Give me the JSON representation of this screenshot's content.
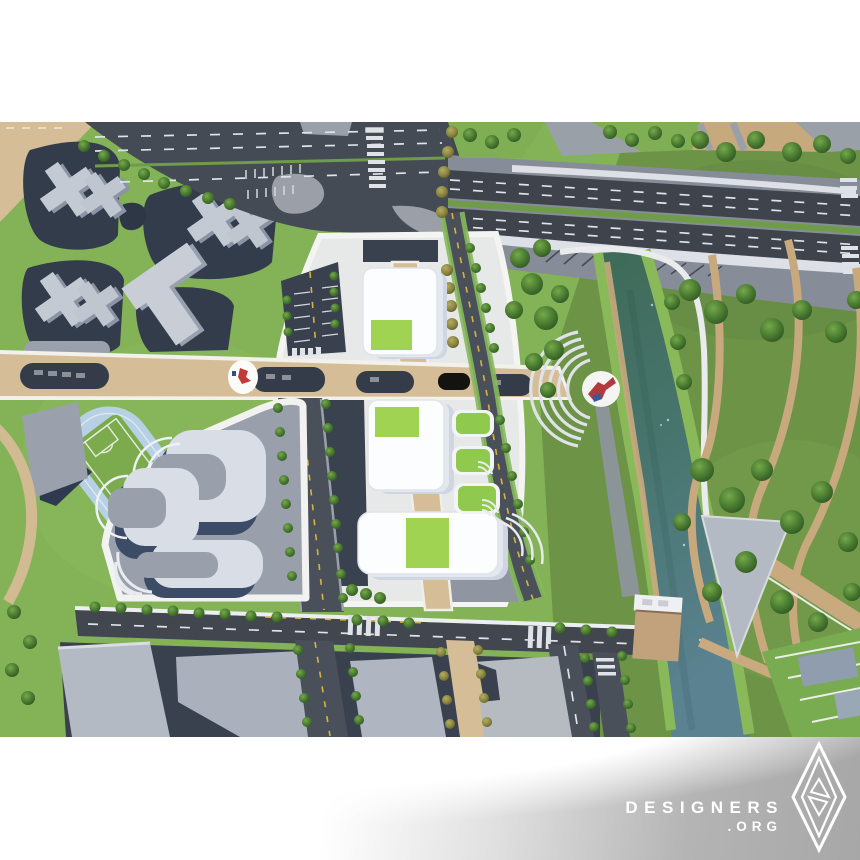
{
  "watermark": {
    "brand": "DESIGNERS",
    "tld": ".ORG",
    "logo_icon": "a-design-award-diamond-icon"
  },
  "scene": {
    "type": "architectural-masterplan-aerial-render",
    "features": [
      "elevated-highway-bridge",
      "river-canal",
      "riverside-park-with-trees",
      "three-white-buildings-with-green-roofs",
      "central-tan-boulevard",
      "sculpture-plaza-circle-flag",
      "sculpture-plaza-circle-bird",
      "running-track-and-soccer-field",
      "terraced-housing-complex",
      "cross-shaped-residential-towers",
      "parking-lots",
      "tree-lined-streets",
      "south-office-blocks",
      "riverside-deck",
      "amphitheater-steps"
    ],
    "palette": {
      "grass": "#83b257",
      "park_green_dark": "#6d9346",
      "asphalt": "#42474f",
      "plaza_navy": "#39414e",
      "tan_road": "#d5bd97",
      "path_tan": "#c8a97e",
      "river_top": "#3e6a57",
      "river_bottom": "#5b8291",
      "track_blue": "#b7d0e3",
      "field_green": "#7cab4d",
      "building_white": "#fcfdfe",
      "roof_green": "#9fd351",
      "building_gray": "#b4bac4",
      "beam_white": "#dde1e7",
      "watermark_silver": "#a7a7a7",
      "sculpture_red": "#c23a38",
      "sculpture_blue": "#2e4f8c"
    }
  }
}
